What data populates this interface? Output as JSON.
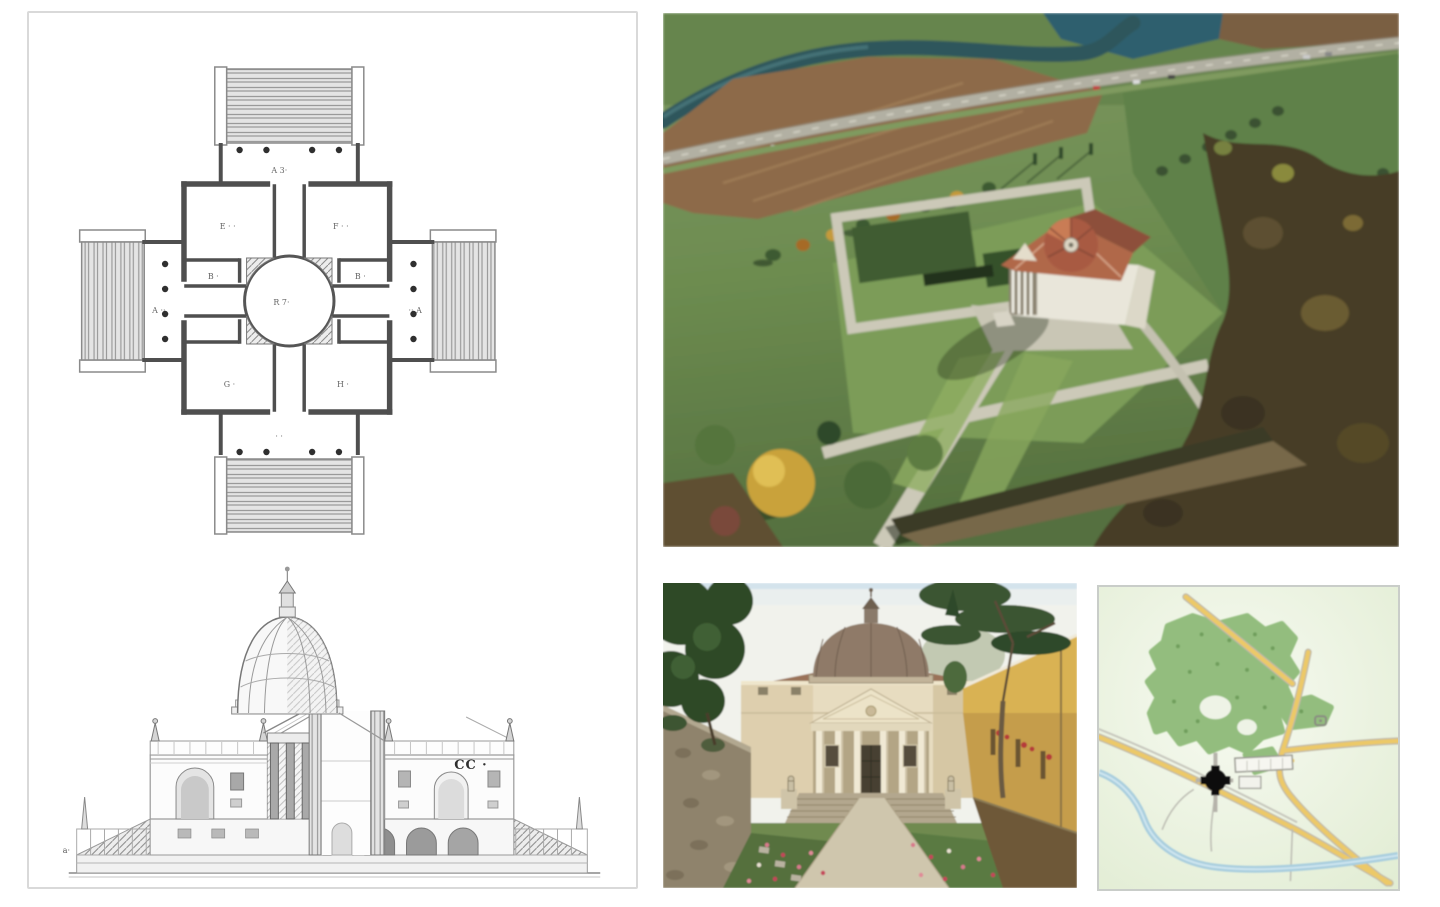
{
  "drawing": {
    "plan_marks": {
      "top_portico": "A 3·",
      "center_hall": "R 7·",
      "west_arm": "A ··",
      "east_arm": "·· A",
      "room_nw": "E · ·",
      "room_ne": "F · ·",
      "room_w": "B ·",
      "room_e": "B ·",
      "room_sw": "G ·",
      "room_se": "H ·",
      "south_portico": "· ·"
    },
    "section_marks": {
      "right_label": "CC ·",
      "left_label": "a·"
    }
  },
  "palette": {
    "frame": "#d9d9d9",
    "map-frame": "#c9cdc9",
    "plan-ink": "#4f4f4f",
    "engraving-ink": "#8a8a8a",
    "label-ink": "#3c3c3c",
    "river": "#2f575c",
    "soil": "#8d6a4a",
    "road": "#b2b0a3",
    "grass-light": "#7d9862",
    "grass-mid": "#6d8c50",
    "grass-dark": "#55703f",
    "field-green": "#5e8148",
    "lawn": "#7c9c58",
    "tree-dark": "#3a5130",
    "tree-autumn": "#c9a23b",
    "wood-brown": "#473d27",
    "path-stone": "#ccc9b8",
    "hedge": "#3f5c33",
    "villa-white": "#e9e6da",
    "roof-red": "#b0674a",
    "dome-red": "#a85a42",
    "sky": "#f1f2ec",
    "cream": "#e7dcc0",
    "fac-dome": "#8f7a68",
    "ochre": "#c59d4b",
    "stone": "#8f836c",
    "gravel": "#cfc6ad",
    "bed": "#546f3e",
    "flower": "#d8798c",
    "map-bg": "#eef4e2",
    "forest": "#93bd7e",
    "road-yellow": "#ecc968",
    "stream": "#a9cede",
    "map-ink": "#9a9a92",
    "villa-black": "#0c0c0c"
  }
}
